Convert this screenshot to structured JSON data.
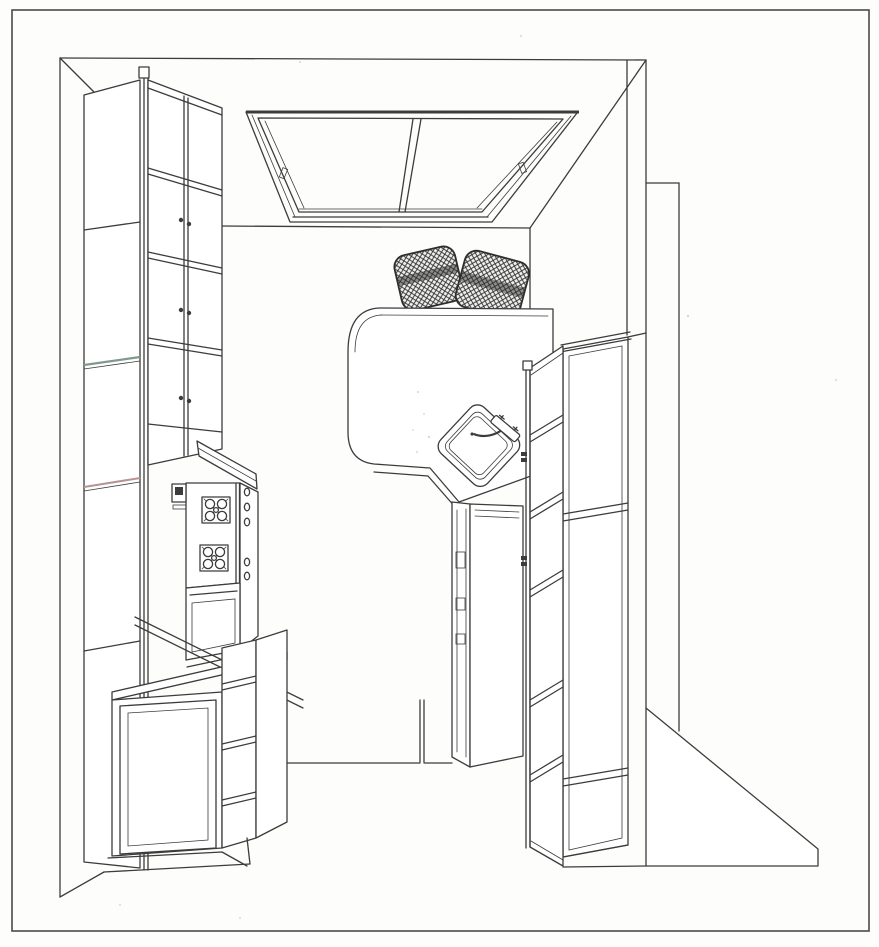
{
  "meta": {
    "title": "Kitchen interior perspective line drawing",
    "description": "Black and white CAD-style perspective rendering of a galley kitchen with ceiling skylight, tall cabinets, range, peninsula counter with two wicker stools, and corner sink."
  },
  "palette": {
    "paper": "#fdfdfb",
    "line": "#3c3c3c",
    "line_light": "#9a9a9a",
    "shelf_green": "#7f9a8c",
    "shelf_rose": "#b79494",
    "panel": "#ffffff",
    "wicker_bg": "#efefed",
    "wicker_line": "#2e2e2e"
  },
  "components": {
    "drawing": {
      "label": "kitchen perspective line drawing"
    },
    "border": {
      "label": "drawing border frame"
    },
    "room": {
      "label": "room walls ceiling and floor lines"
    },
    "skylight": {
      "label": "ceiling skylight with two glass panes"
    },
    "left_tall_cabinet": {
      "label": "tall left cabinet with open door and shelves"
    },
    "upper_cabinet_band": {
      "label": "left wall upper cabinets with glass doors"
    },
    "range_hood": {
      "label": "range hood"
    },
    "range": {
      "label": "range with two burners, control knobs and oven"
    },
    "base_cabinets_left": {
      "label": "foreground base cabinets with door and drawers"
    },
    "peninsula": {
      "label": "peninsula counter with rounded corner"
    },
    "stool_left": {
      "label": "left wicker stool"
    },
    "stool_right": {
      "label": "right wicker stool"
    },
    "sink": {
      "label": "diagonal corner sink with faucet"
    },
    "sink_base": {
      "label": "sink base cabinet"
    },
    "right_tall_cabinet": {
      "label": "tall right cabinet"
    },
    "right_cabinet_door": {
      "label": "open paneled door of right cabinet"
    },
    "floor": {
      "label": "floor lines and wall base wedge"
    }
  }
}
